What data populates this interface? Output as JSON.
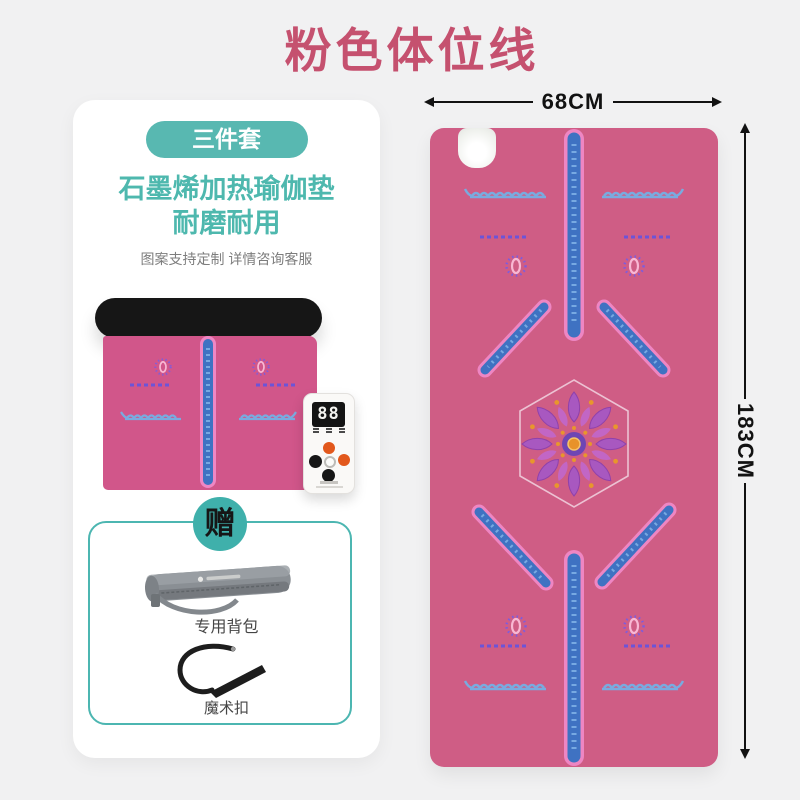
{
  "title": "粉色体位线",
  "colors": {
    "title_pink": "#c5516f",
    "teal_accent": "#4cb6b1",
    "mat_pink": "#cf5d85",
    "guide_line_blue": "#3f72c2",
    "wave_blue": "#79abdf",
    "dash_purple": "#6c54d8",
    "background": "#f1f1f2"
  },
  "left_card": {
    "set_badge": "三件套",
    "heading_line1": "石墨烯加热瑜伽垫",
    "heading_line2": "耐磨耐用",
    "note": "图案支持定制 详情咨询客服",
    "remote": {
      "display": "88"
    },
    "gift": {
      "badge": "赠",
      "items": [
        {
          "label": "专用背包"
        },
        {
          "label": "魔术扣"
        }
      ]
    }
  },
  "dimensions": {
    "width": "68CM",
    "height": "183CM"
  },
  "icons": {
    "mandala": "mandala-icon",
    "lotus": "lotus-icon",
    "pocket": "controller-pocket",
    "arrows": [
      "arrow-left-icon",
      "arrow-right-icon",
      "arrow-up-icon",
      "arrow-down-icon"
    ]
  }
}
